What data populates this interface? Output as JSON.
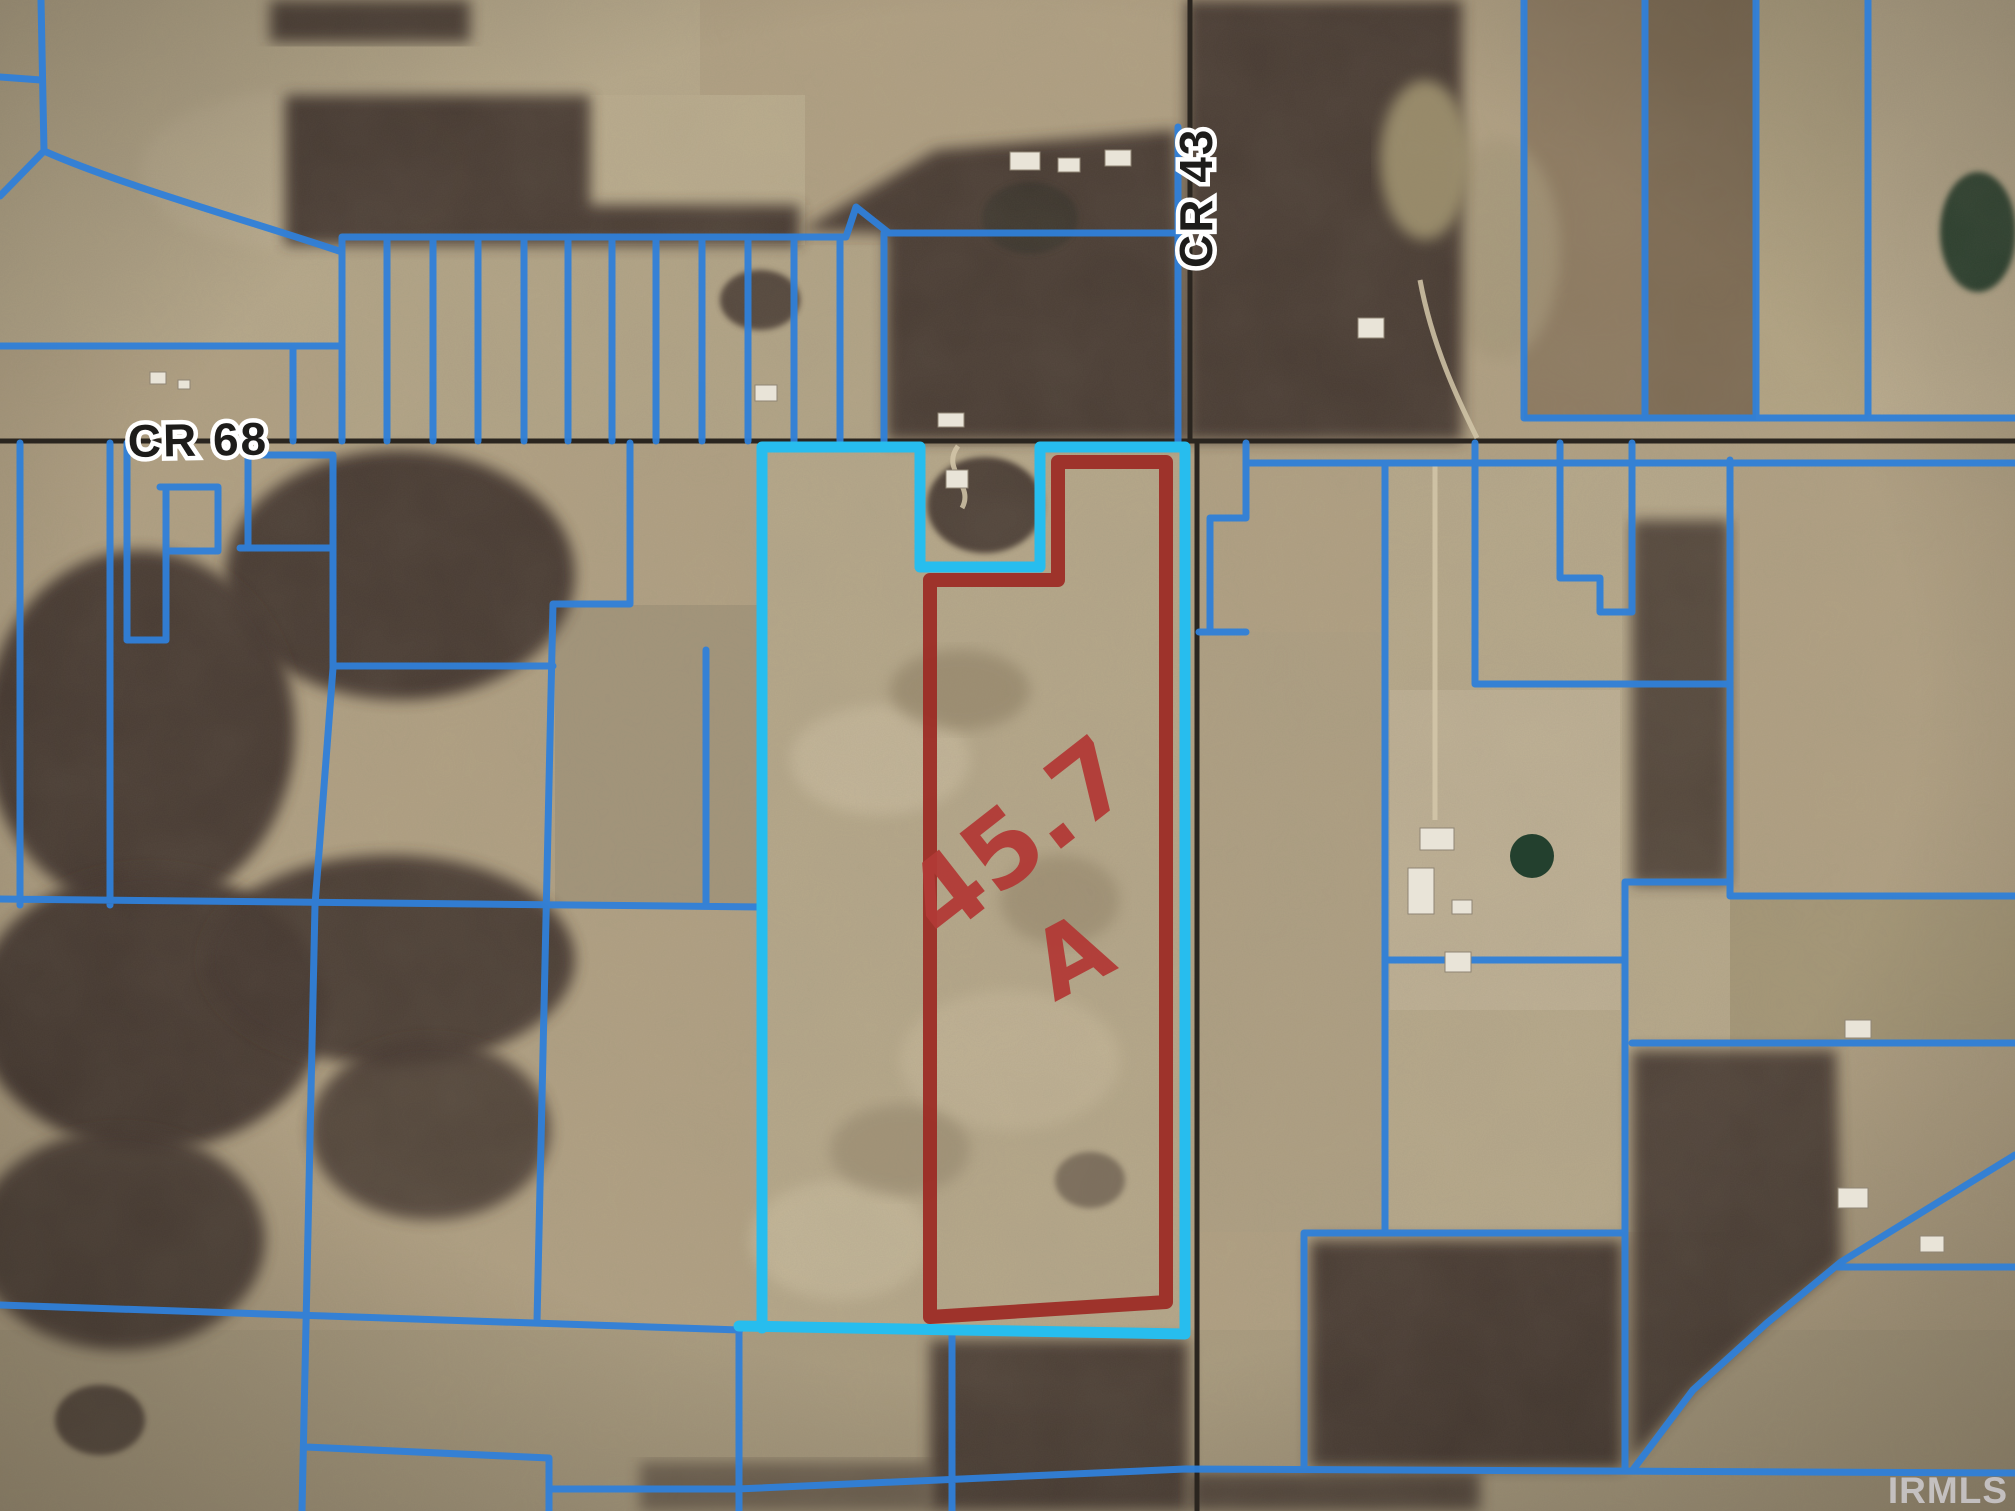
{
  "map": {
    "title": "aerial parcel map",
    "roads": {
      "horizontal": "CR 68",
      "vertical": "CR 43"
    },
    "annotation": {
      "acreage": "45.7",
      "unit": "A"
    },
    "watermark": "IRMLS"
  },
  "colors": {
    "parcel-line": "#2f80d9",
    "highlight-line": "#27bdee",
    "subject-outline": "#9c2a24",
    "annotation-red": "#b23a36",
    "road-dark": "#2a251f",
    "label-ink": "#1d1c1a",
    "label-halo": "#ffffff",
    "watermark-gray": "#d6d4da",
    "field-base": "#b2a284",
    "woods-dark": "#43352d"
  }
}
